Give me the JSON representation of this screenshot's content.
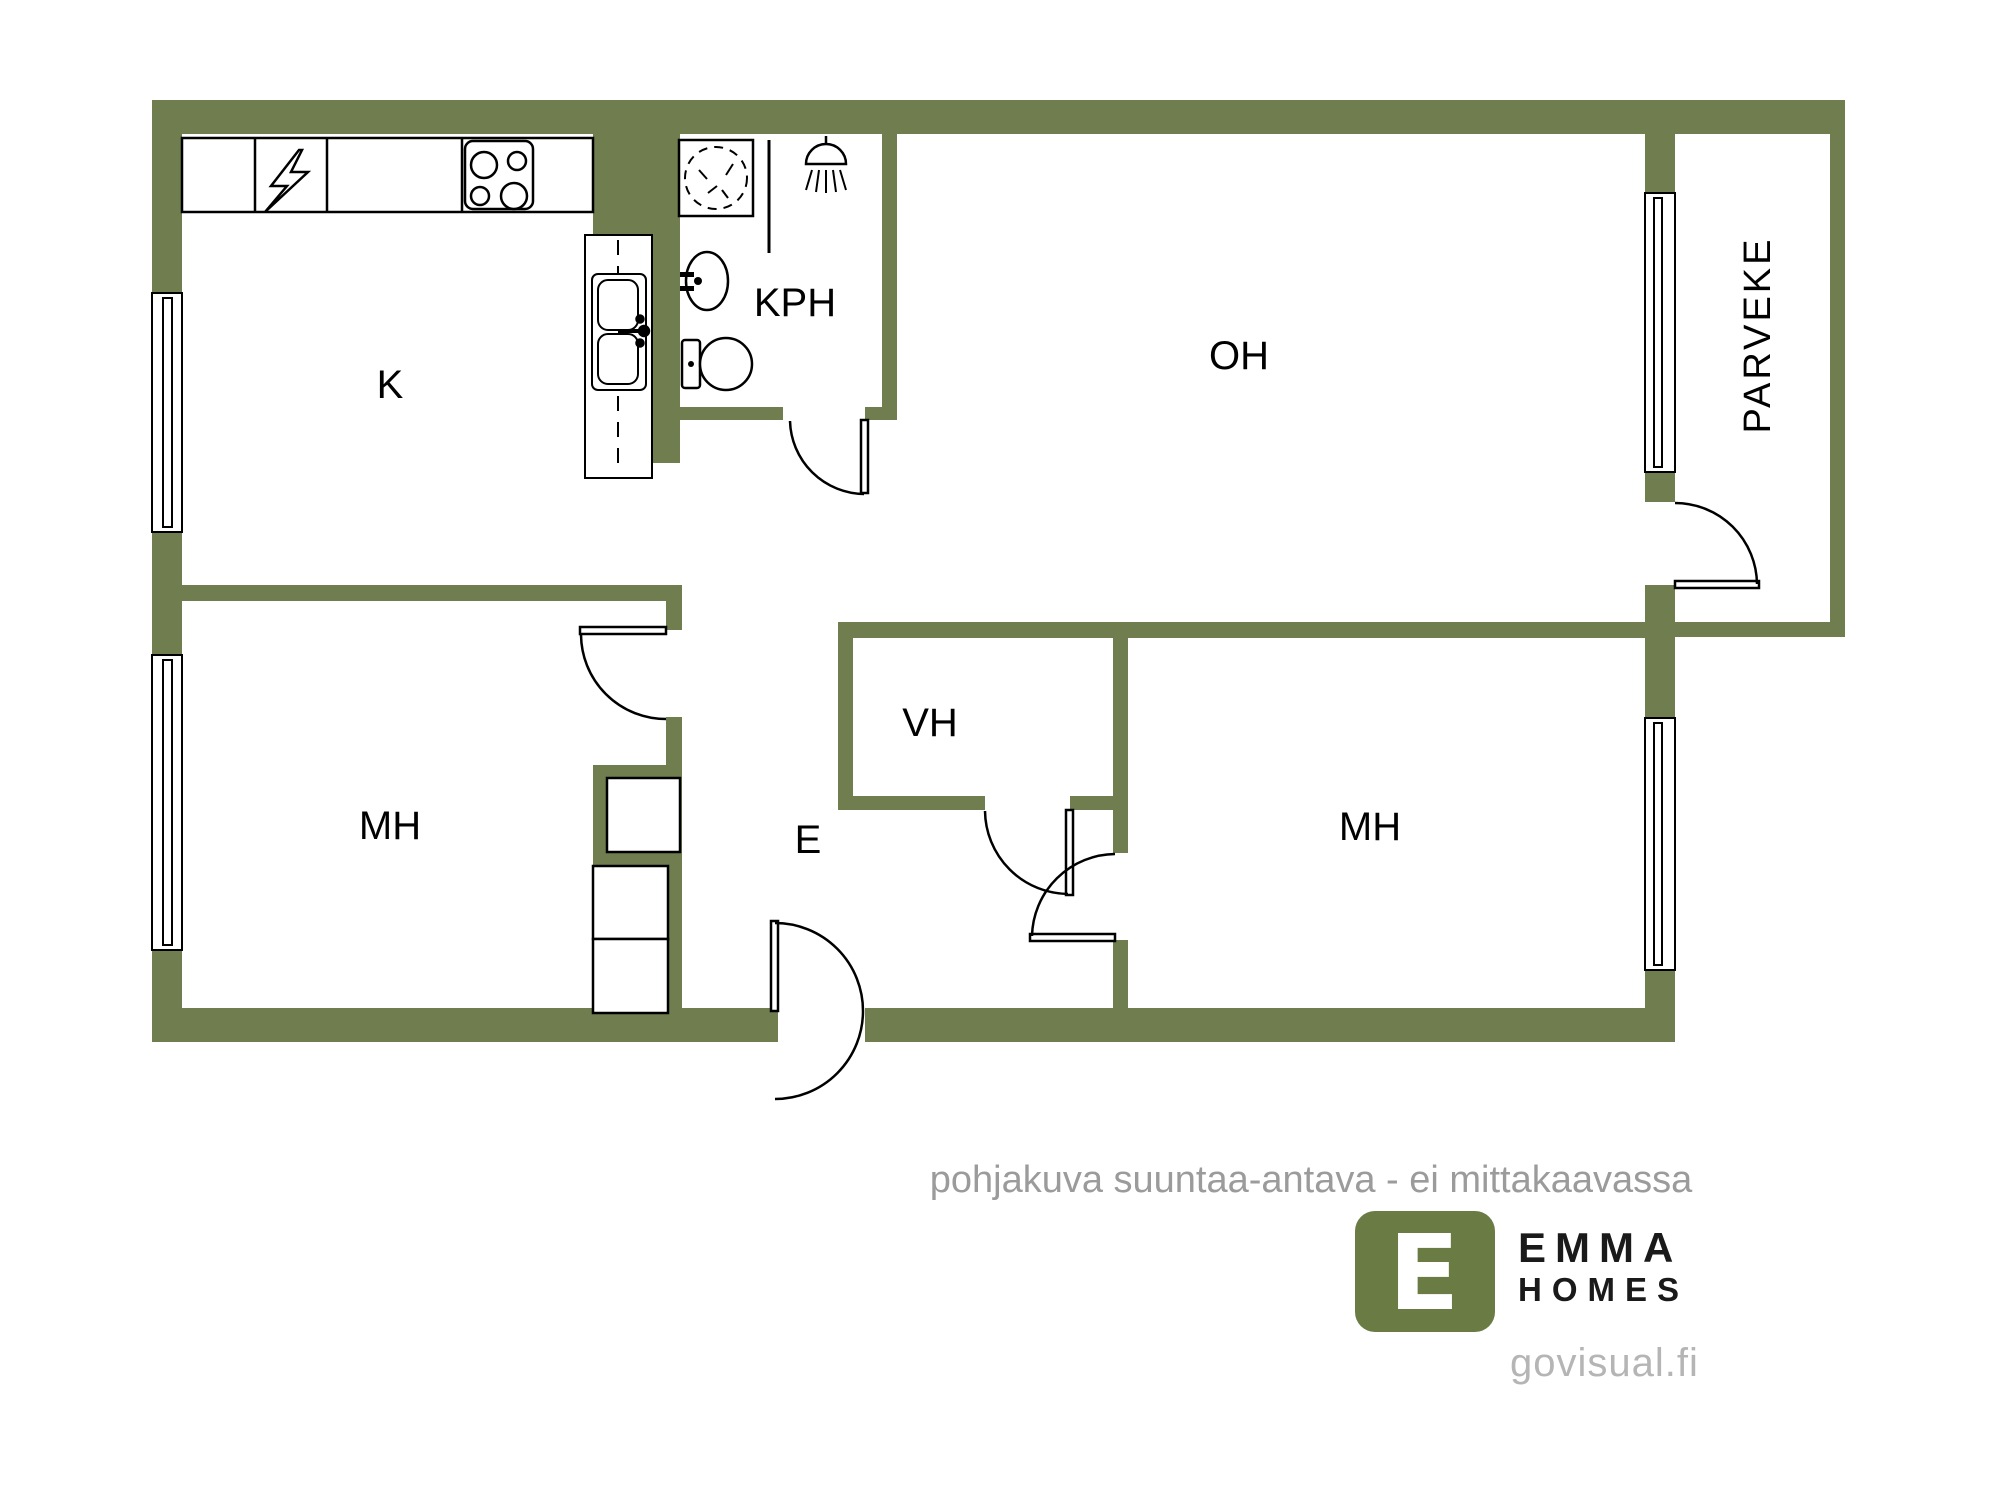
{
  "colors": {
    "wall": "#6F7D4F",
    "line": "#000000",
    "fixture_fill": "#ffffff",
    "room_label": "#000000",
    "disclaimer": "#9B9B9B",
    "logo_green": "#6B7B44",
    "logo_text": "#1A1A1A",
    "logo_mark_letter": "#FFFFFF",
    "website": "#B5B5B5"
  },
  "rooms": {
    "kitchen": {
      "label": "K"
    },
    "bathroom": {
      "label": "KPH"
    },
    "living_room": {
      "label": "OH"
    },
    "balcony": {
      "label": "PARVEKE"
    },
    "bedroom_left": {
      "label": "MH"
    },
    "closet": {
      "label": "VH"
    },
    "entry": {
      "label": "E"
    },
    "bedroom_right": {
      "label": "MH"
    }
  },
  "fixtures": {
    "stove": "stove-icon",
    "electrical_cabinet": "lightning-icon",
    "kitchen_sink": "double-sink-icon",
    "washing_machine": "washing-machine-icon",
    "shower": "shower-icon",
    "bathroom_sink": "sink-icon",
    "toilet": "toilet-icon",
    "wardrobe_count": 3,
    "window_count": 4,
    "door_count": 6
  },
  "disclaimer": "pohjakuva suuntaa-antava - ei mittakaavassa",
  "logo": {
    "mark": "E",
    "name_line1": "EMMA",
    "name_line2": "HOMES",
    "website": "govisual.fi"
  }
}
